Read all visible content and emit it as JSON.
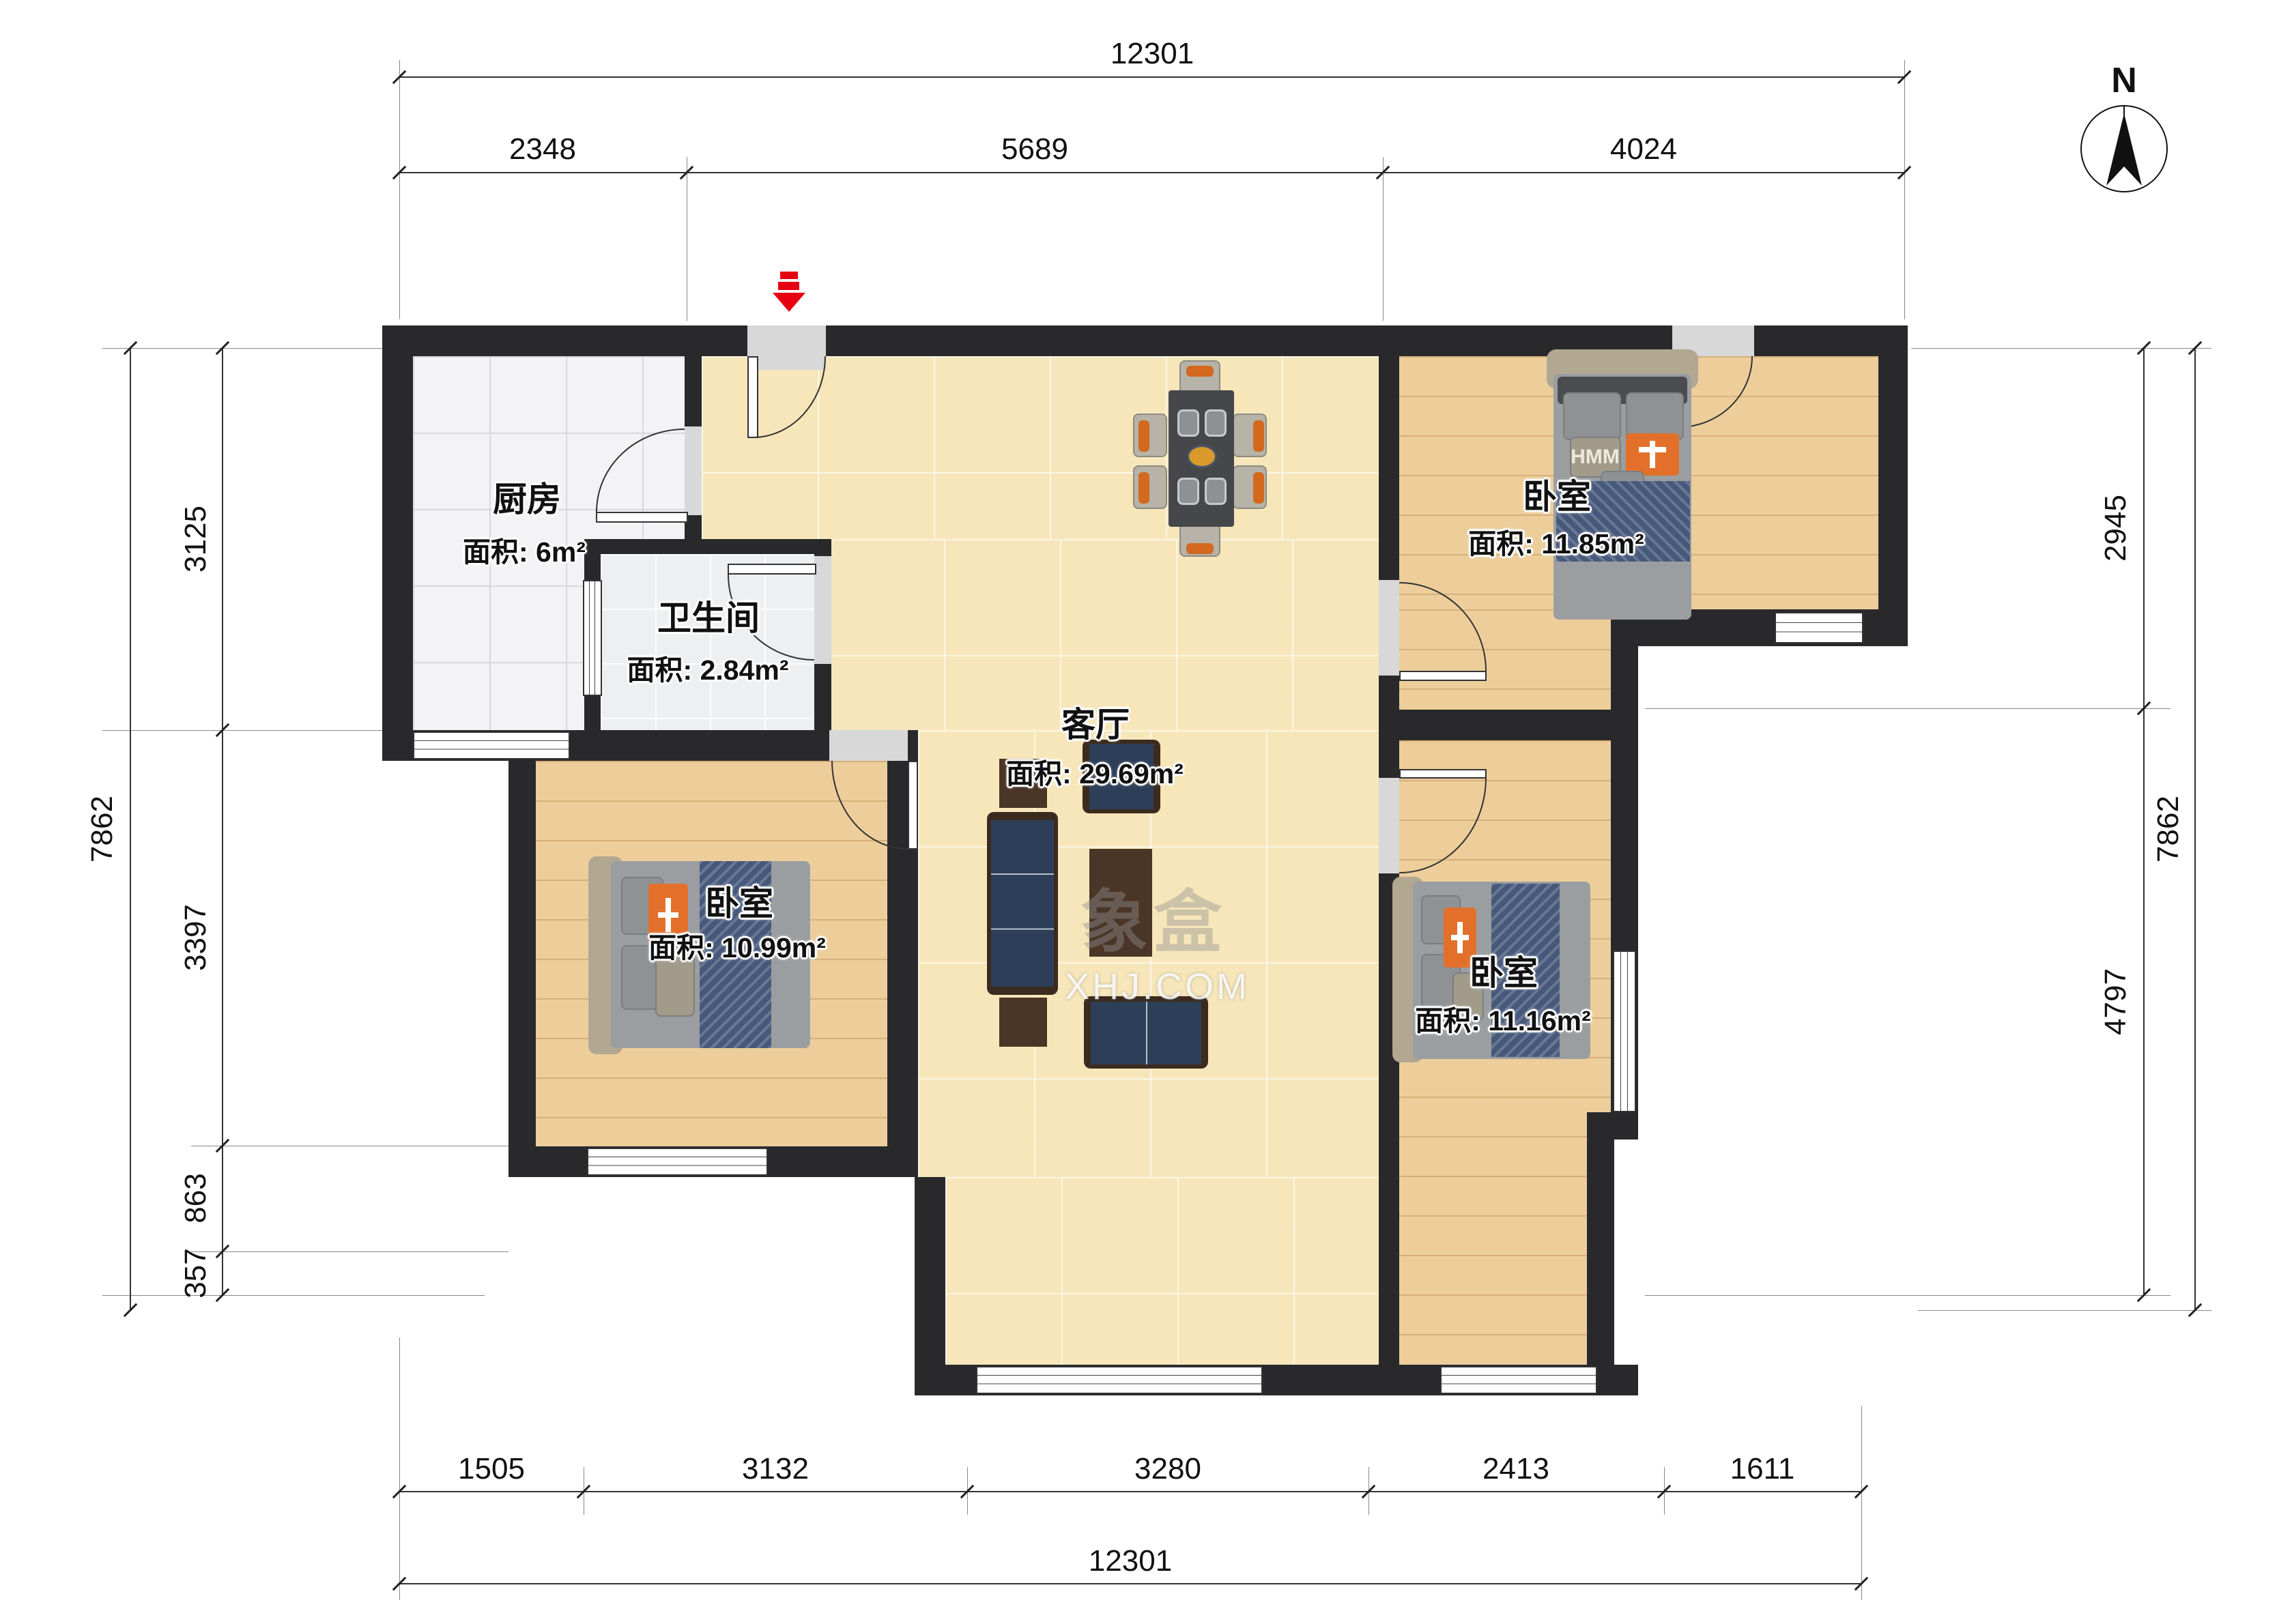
{
  "north": {
    "label": "N"
  },
  "watermark": {
    "brand": "象盒",
    "domain": "XHJ.COM"
  },
  "rooms": {
    "kitchen": {
      "name": "厨房",
      "area": "面积: 6m²"
    },
    "bathroom": {
      "name": "卫生间",
      "area": "面积: 2.84m²"
    },
    "living": {
      "name": "客厅",
      "area": "面积: 29.69m²"
    },
    "bedroom_top_right": {
      "name": "卧室",
      "area": "面积: 11.85m²"
    },
    "bedroom_left": {
      "name": "卧室",
      "area": "面积: 10.99m²"
    },
    "bedroom_bottom_right": {
      "name": "卧室",
      "area": "面积: 11.16m²"
    }
  },
  "beds": {
    "pillow_text": "HMM"
  },
  "dimensions": {
    "top": {
      "total": "12301",
      "segments": [
        "2348",
        "5689",
        "4024"
      ]
    },
    "bottom": {
      "total": "12301",
      "segments": [
        "1505",
        "3132",
        "3280",
        "2413",
        "1611"
      ]
    },
    "left": {
      "total": "7862",
      "segments": [
        "3125",
        "3397",
        "863",
        "357"
      ]
    },
    "right": {
      "total": "7862",
      "segments": [
        "2945",
        "4797"
      ]
    }
  }
}
